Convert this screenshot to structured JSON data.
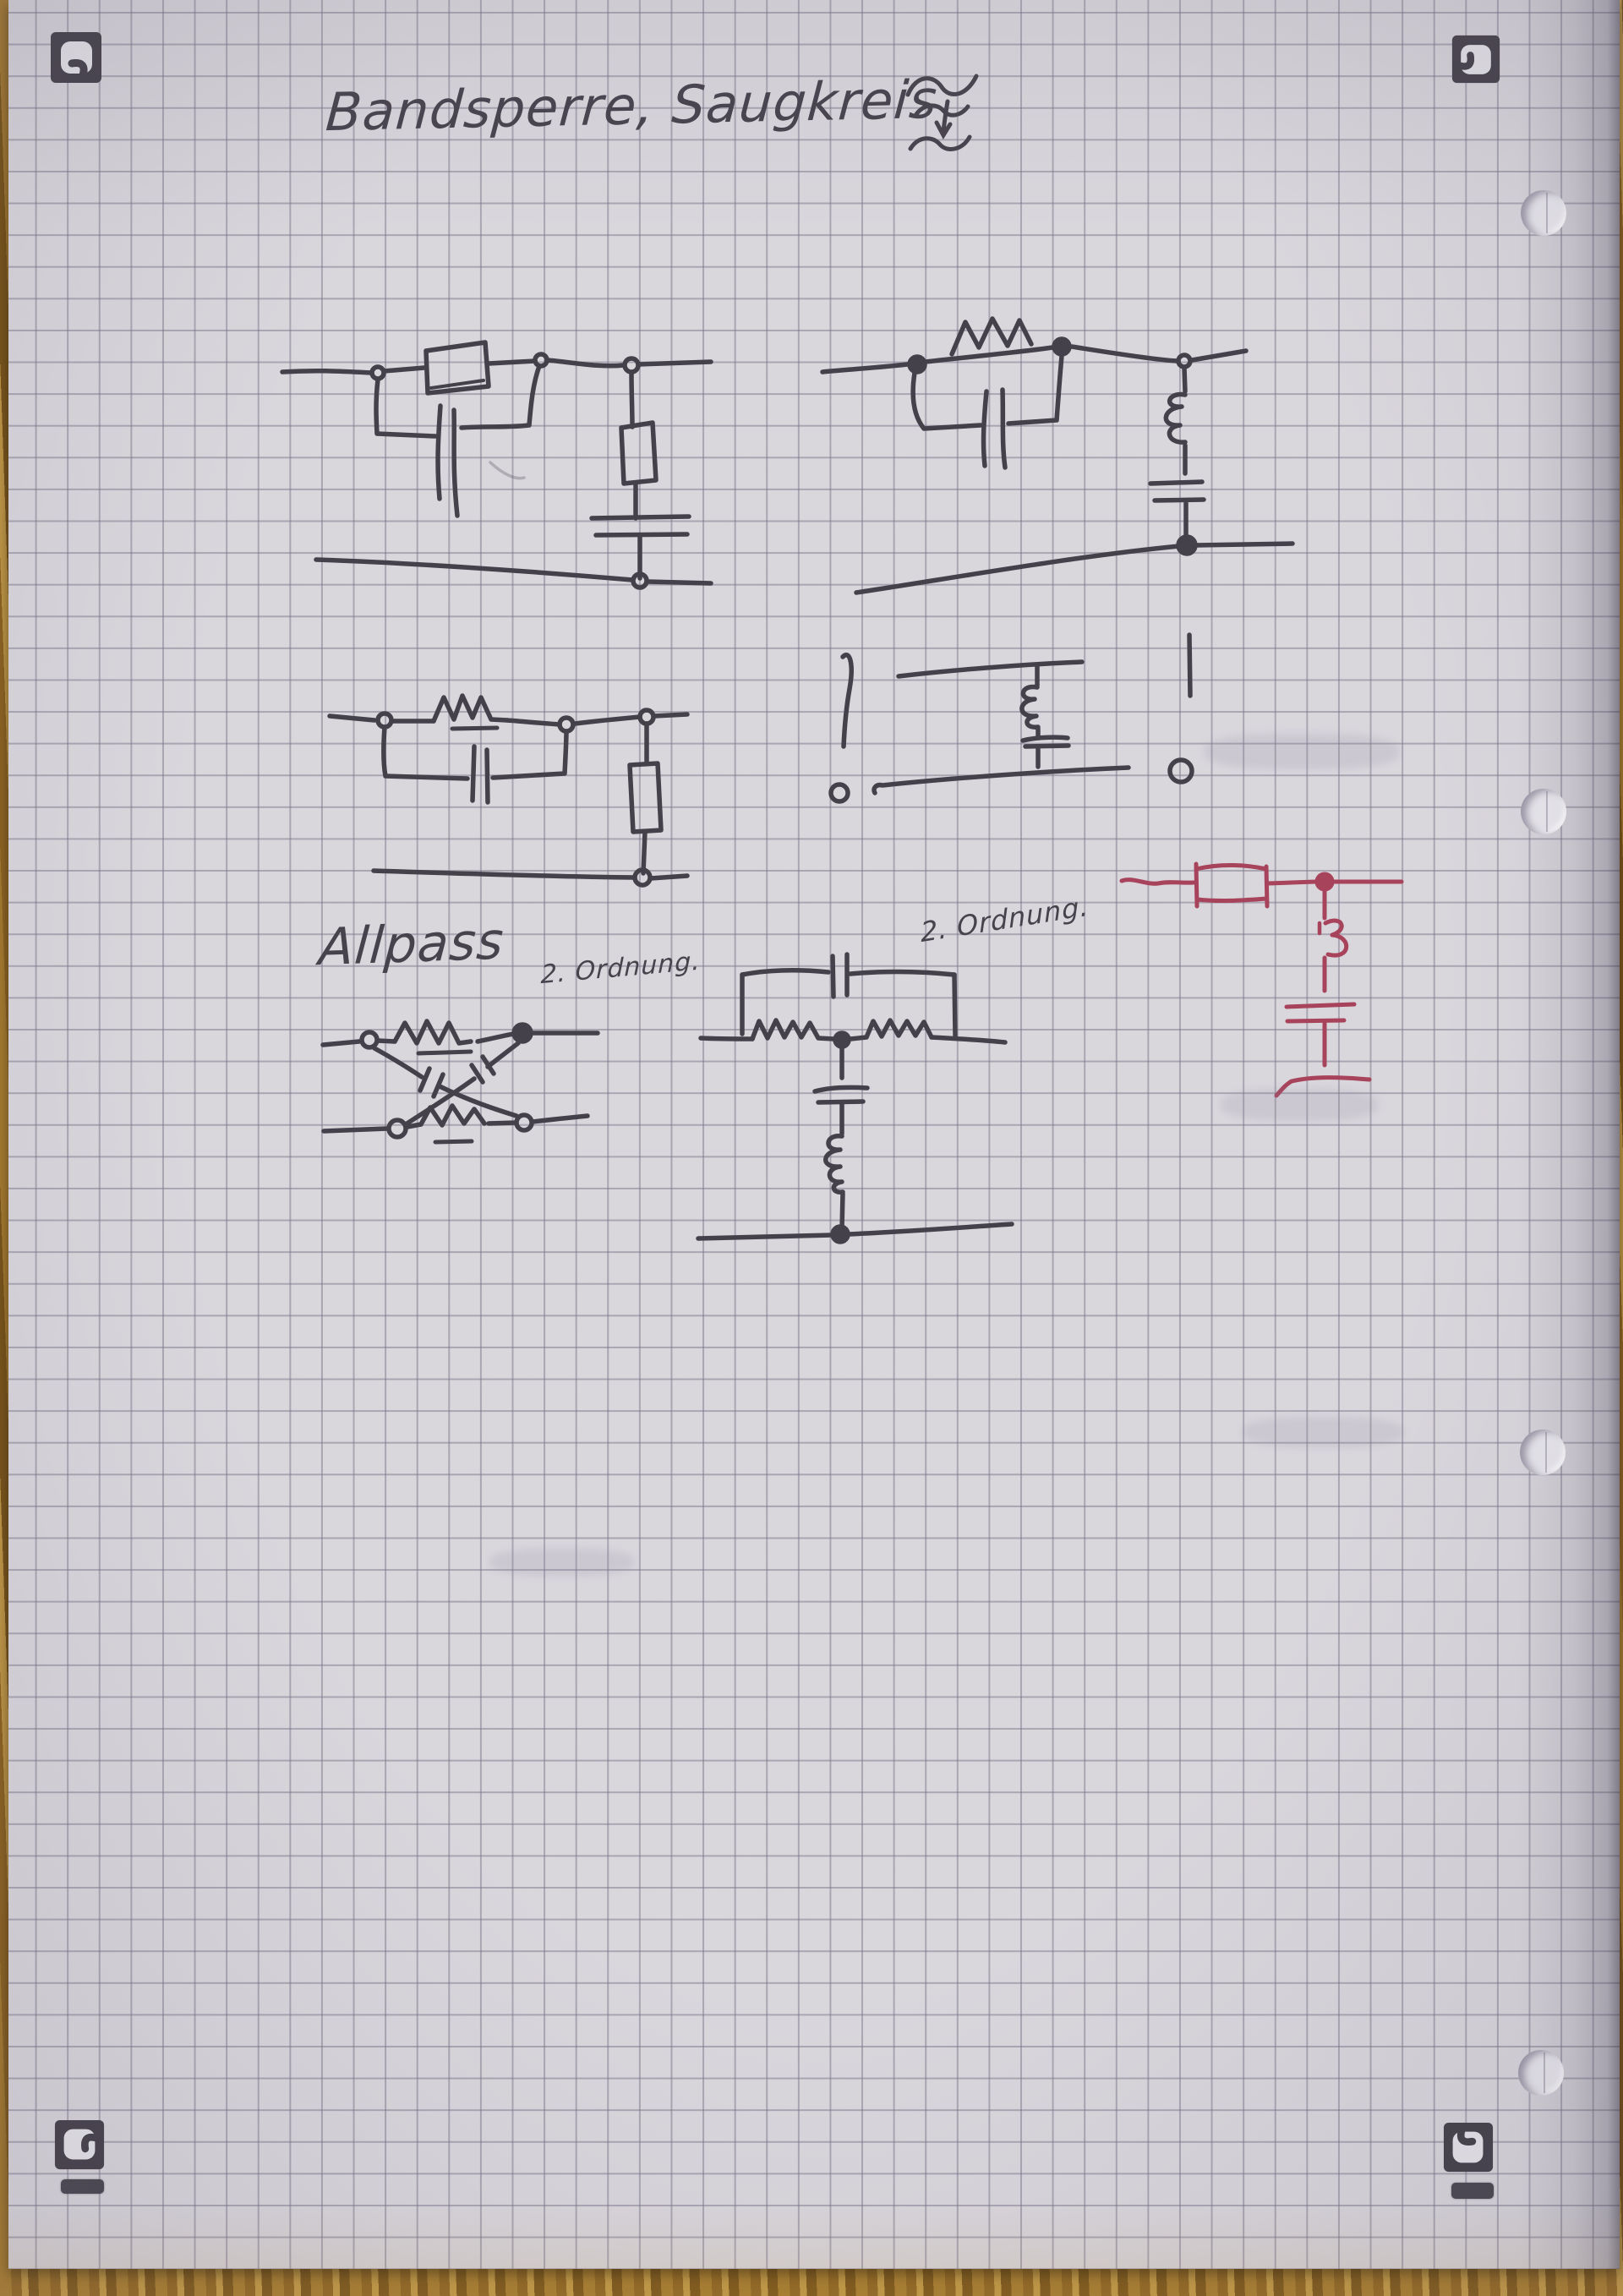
{
  "meta": {
    "description": "Photograph of a squared-paper notebook page with hand-drawn analog filter circuit sketches, scan corner markers, punch holes and a wooden table edge",
    "language": "de"
  },
  "colors": {
    "paper": "#d9d6dc",
    "grid": "#8f8b99",
    "ink": "#45414b",
    "red_ink": "#a8435c",
    "marker": "#45414a",
    "wood": "#9b712a"
  },
  "title": {
    "text": "Bandsperre, Saugkreis",
    "symbol": "frequency-change-squiggle (tilde, down arrow, tilde)"
  },
  "labels": {
    "allpass": "Allpass",
    "allpass_order": "2. Ordnung.",
    "bridged_t_order": "2. Ordnung."
  },
  "annotations": {
    "left_port_mark": "!",
    "right_port_mark": "!",
    "left_terminal": "o",
    "right_terminal": "o"
  },
  "scan_frame": {
    "corner_markers": [
      "top-left",
      "top-right",
      "bottom-left",
      "bottom-right"
    ],
    "marker_bars": [
      "bottom-left",
      "bottom-right"
    ],
    "punch_holes": {
      "count": 4,
      "side": "right"
    }
  },
  "circuits": [
    {
      "id": "bandstop-boxed-element-parallel-C",
      "position": "top-left",
      "ink": "black",
      "description": "Series boxed impedance bridged by a parallel capacitor branch; shunt branch of boxed resistor in series with capacitor down to the bottom rail"
    },
    {
      "id": "bandstop-R-parallel-C-with-LC-shunt",
      "position": "top-right",
      "ink": "black",
      "description": "Series resistor (zigzag) in parallel with a capacitor; shunt inductor-capacitor (Saugkreis) branch to the bottom rail"
    },
    {
      "id": "parallel-RC-with-shunt-box-R",
      "position": "middle-left",
      "ink": "black",
      "description": "Series resistor in parallel with capacitor; shunt boxed resistor down to the bottom rail"
    },
    {
      "id": "saugkreis-open-two-port",
      "position": "middle-right",
      "ink": "black",
      "description": "Open two-port marked with ! strokes and o terminals; shunt series inductor-capacitor branch between top and bottom rails"
    },
    {
      "id": "red-series-R-shunt-LC",
      "position": "right",
      "ink": "red",
      "description": "Series boxed resistor, node, then shunt inductor in series with capacitor to a ground bar"
    },
    {
      "id": "allpass-lattice",
      "position": "bottom-left",
      "ink": "black",
      "description": "Lattice all-pass second order: series resistors in top and bottom rails, crossed diagonal capacitor branches"
    },
    {
      "id": "bridged-t-notch",
      "position": "bottom-middle",
      "ink": "black",
      "description": "Bridged-T: capacitor bridging two series resistors, centre node with capacitor and inductor shunt branch to bottom rail"
    }
  ]
}
